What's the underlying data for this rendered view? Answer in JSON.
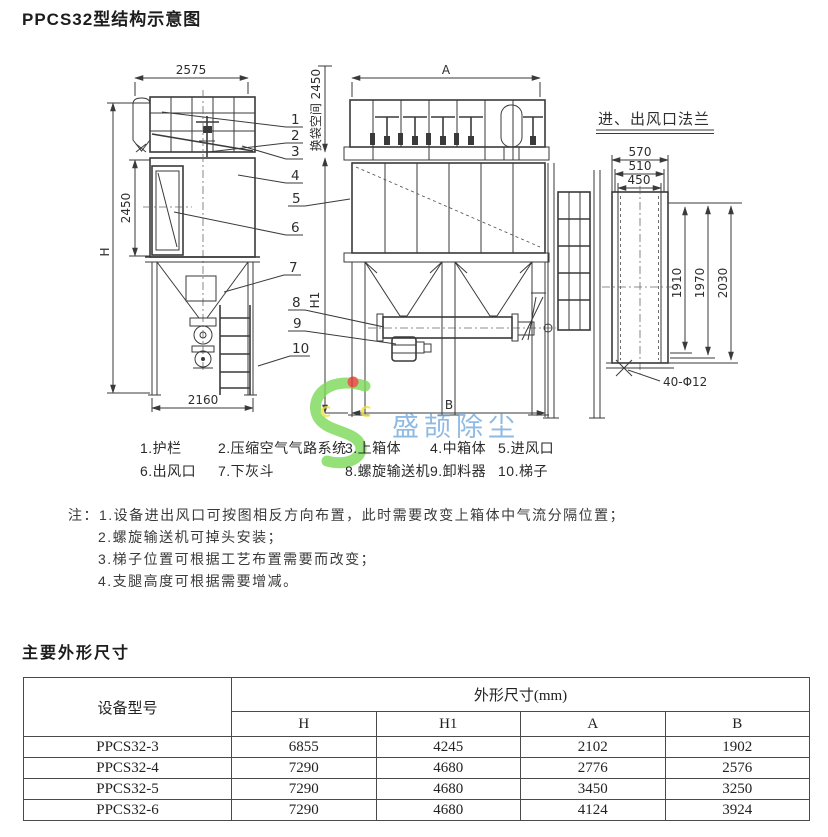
{
  "page": {
    "title": "PPCS32型结构示意图",
    "section2_title": "主要外形尺寸"
  },
  "drawing": {
    "side_view": {
      "dim_top": "2575",
      "dim_box": "2450",
      "dim_h": "H",
      "dim_base": "2160"
    },
    "front_view": {
      "dim_a": "A",
      "dim_b": "B",
      "dim_h1": "H1",
      "dim_bag_space": "换袋空间 2450"
    },
    "flange_view": {
      "title": "进、出风口法兰",
      "dims_w": [
        "570",
        "510",
        "450"
      ],
      "dims_h": [
        "1910",
        "1970",
        "2030"
      ],
      "holes_label": "40-Φ12"
    },
    "callouts": [
      "1",
      "2",
      "3",
      "4",
      "5",
      "6",
      "7",
      "8",
      "9",
      "10"
    ]
  },
  "legend": {
    "row1": [
      "1.护栏",
      "2.压缩空气气路系统",
      "3.上箱体",
      "4.中箱体",
      "5.进风口"
    ],
    "row2": [
      "6.出风口",
      "7.下灰斗",
      "8.螺旋输送机",
      "9.卸料器",
      "10.梯子"
    ]
  },
  "notes": {
    "prefix": "注：",
    "items": [
      "1.设备进出风口可按图相反方向布置，此时需要改变上箱体中气流分隔位置；",
      "2.螺旋输送机可掉头安装；",
      "3.梯子位置可根据工艺布置需要而改变；",
      "4.支腿高度可根据需要增减。"
    ]
  },
  "dimensions_table": {
    "device_col_header": "设备型号",
    "group_header": "外形尺寸(mm)",
    "sub_headers": [
      "H",
      "H1",
      "A",
      "B"
    ],
    "rows": [
      {
        "model": "PPCS32-3",
        "values": [
          "6855",
          "4245",
          "2102",
          "1902"
        ]
      },
      {
        "model": "PPCS32-4",
        "values": [
          "7290",
          "4680",
          "2776",
          "2576"
        ]
      },
      {
        "model": "PPCS32-5",
        "values": [
          "7290",
          "4680",
          "3450",
          "3250"
        ]
      },
      {
        "model": "PPCS32-6",
        "values": [
          "7290",
          "4680",
          "4124",
          "3924"
        ]
      }
    ]
  },
  "watermark": {
    "logo_letters": "C C",
    "brand_text": "盛颉除尘",
    "green": "#7bd957",
    "blue": "#5b9bd5",
    "red": "#e03a2f",
    "yellow": "#f0e040"
  }
}
